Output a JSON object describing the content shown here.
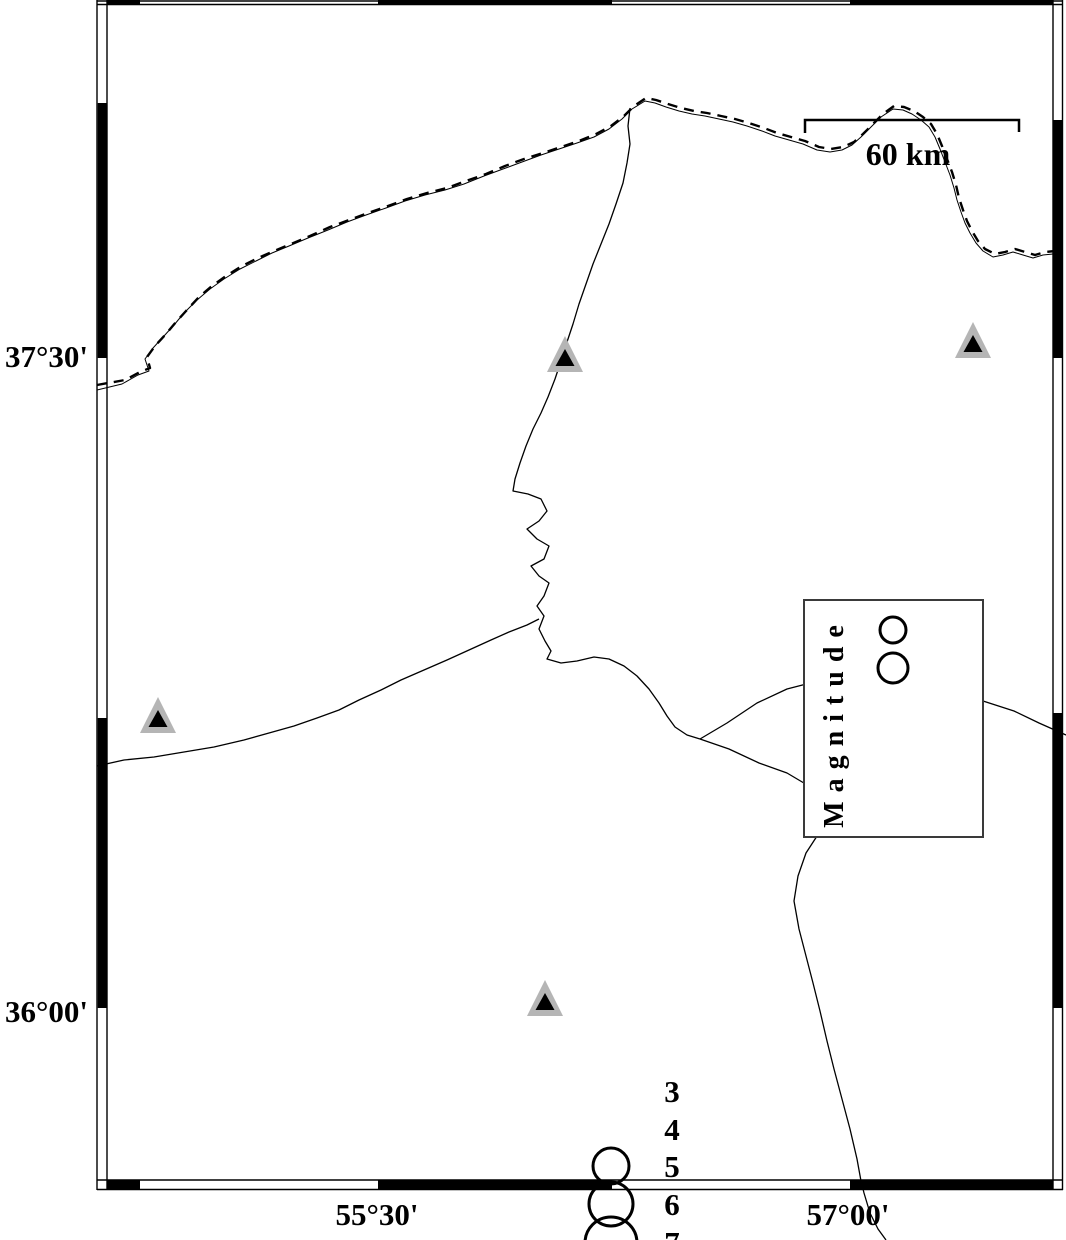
{
  "map": {
    "background": "#ffffff",
    "axes": {
      "left": [
        {
          "text": "37°30'"
        },
        {
          "text": "36°00'"
        }
      ],
      "bottom": [
        {
          "text": "55°30'"
        },
        {
          "text": "57°00'"
        }
      ]
    },
    "scale_bar": {
      "label": "60 km"
    },
    "legend": {
      "title": "Magnitude",
      "circles": [
        {
          "cx": 893,
          "cy": 630,
          "r": 13
        },
        {
          "cx": 893,
          "cy": 668,
          "r": 15
        }
      ]
    },
    "magnitude_scale": {
      "label_x": 672,
      "circle_x": 611,
      "entries": [
        {
          "label": "3",
          "label_y": 1102,
          "circle": null
        },
        {
          "label": "4",
          "label_y": 1140,
          "circle": null
        },
        {
          "label": "5",
          "label_y": 1177,
          "circle": {
            "cy": 1166,
            "r": 18
          }
        },
        {
          "label": "6",
          "label_y": 1215,
          "circle": {
            "cy": 1204,
            "r": 22
          }
        },
        {
          "label": "7",
          "label_y": 1253,
          "circle": {
            "cy": 1243,
            "r": 26
          }
        }
      ]
    },
    "stations": [
      {
        "x": 565,
        "y": 357
      },
      {
        "x": 973,
        "y": 343
      },
      {
        "x": 158,
        "y": 718
      },
      {
        "x": 545,
        "y": 1001
      }
    ],
    "colors": {
      "line": "#000000",
      "station_fill": "#b5b5b5",
      "station_core": "#000000"
    }
  }
}
